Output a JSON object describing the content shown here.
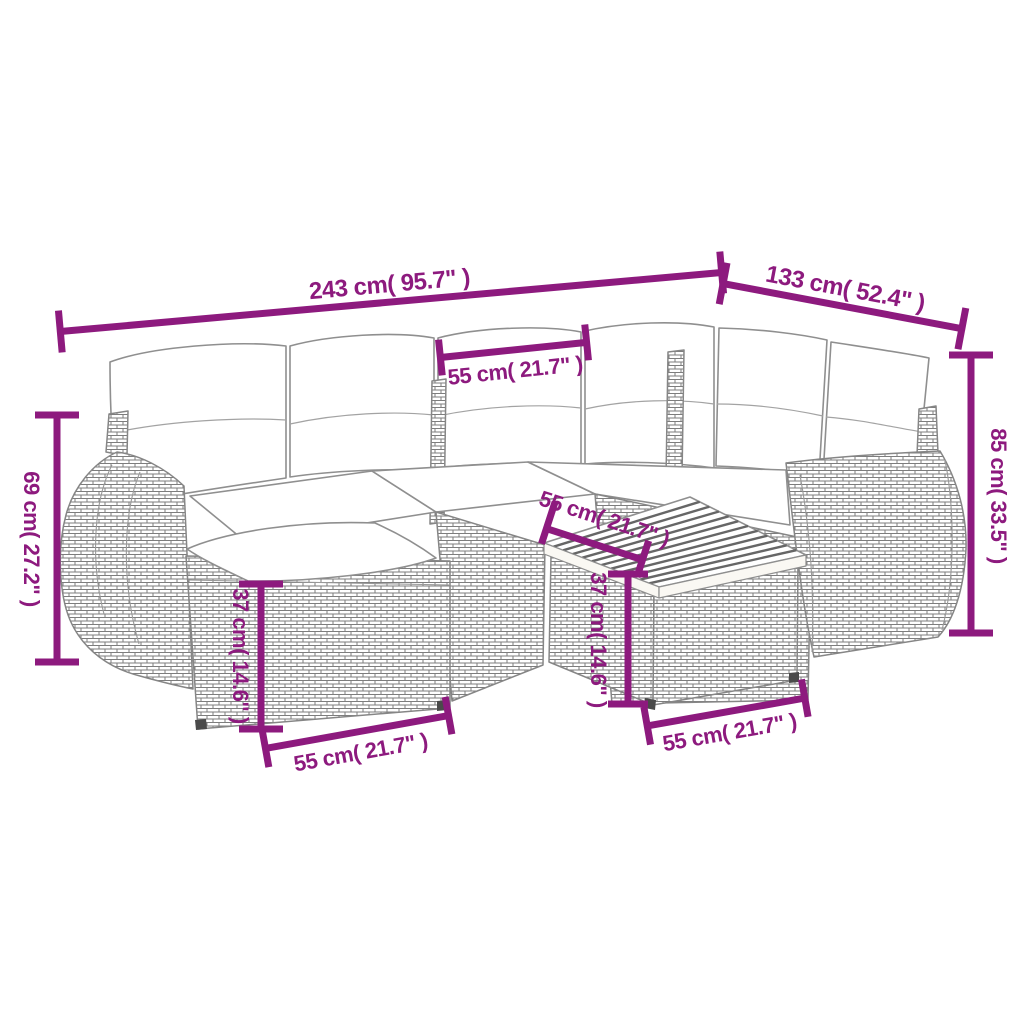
{
  "accent_color": "#8D1A7E",
  "furniture_line_color": "#8f8f8f",
  "dimensions": {
    "overall_width": "243 cm( 95.7\" )",
    "overall_depth": "133 cm( 52.4\" )",
    "seat_width": "55 cm( 21.7\" )",
    "armrest_height": "69 cm( 27.2\" )",
    "back_height": "85 cm( 33.5\" )",
    "footstool_height": "37 cm( 14.6\" )",
    "footstool_width": "55 cm( 21.7\" )",
    "table_depth": "55 cm( 21.7\" )",
    "table_height": "37 cm( 14.6\" )",
    "table_width": "55 cm( 21.7\" )"
  }
}
